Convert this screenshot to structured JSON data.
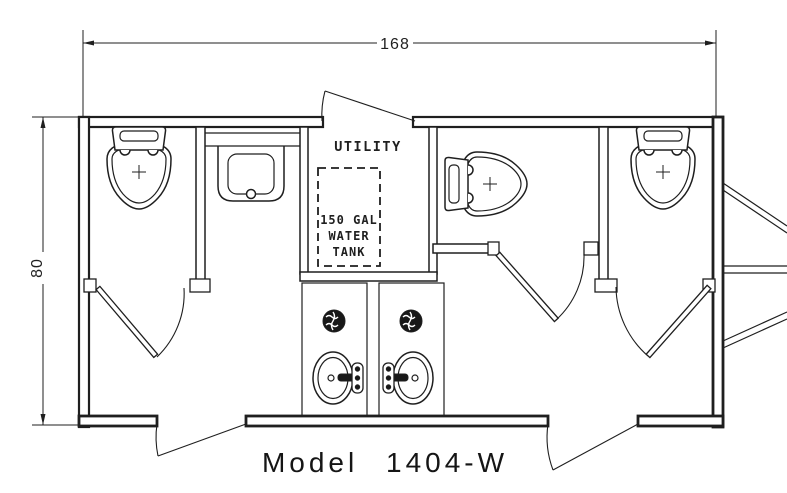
{
  "drawing": {
    "model_label": "Model 1404-W",
    "width_dimension": "168",
    "height_dimension": "80",
    "utility_room_label": "UTILITY",
    "water_tank_label": {
      "line1": "150 GAL",
      "line2": "WATER",
      "line3": "TANK"
    },
    "colors": {
      "line": "#1f1f1f",
      "background": "#ffffff"
    },
    "fixtures": {
      "toilet_icon": "top-view-toilet",
      "sink_icon": "oval-sink-with-faucet",
      "vanity_sink_icon": "counter-sink-basin",
      "drain_icon": "floor-drain",
      "hitch_icon": "trailer-tongue-hitch",
      "toilet_count": 3,
      "sink_count": 3
    }
  }
}
